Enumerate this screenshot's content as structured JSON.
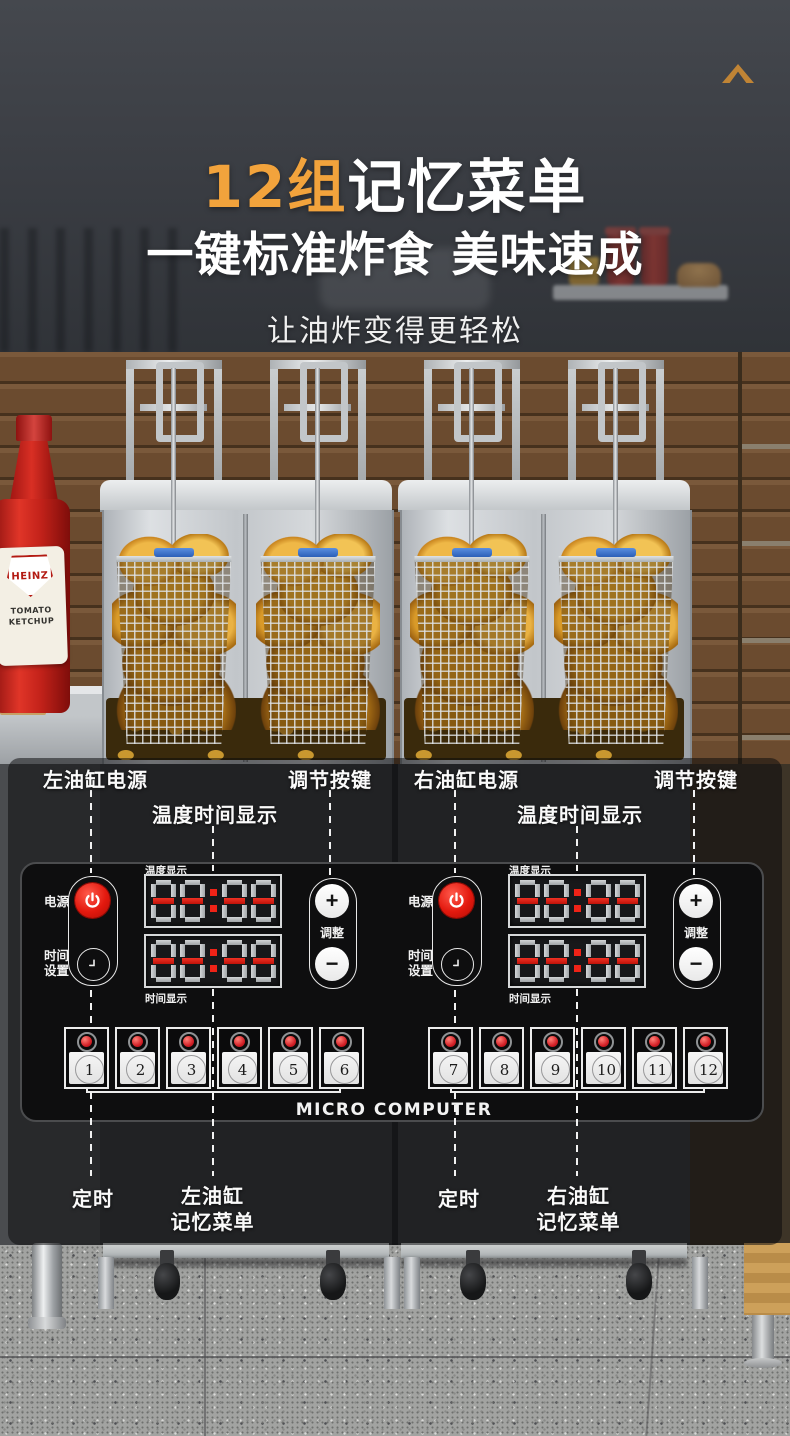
{
  "header": {
    "title_highlight": "12组",
    "title_rest": "记忆菜单",
    "subtitle": "一键标准炸食 美味速成",
    "tagline": "让油炸变得更轻松",
    "accent_color": "#f2a33c"
  },
  "photo": {
    "ketchup_brand": "HEINZ",
    "ketchup_label": "TOMATO KETCHUP"
  },
  "callouts": {
    "left_power": "左油缸电源",
    "left_display": "温度时间显示",
    "left_adjust": "调节按键",
    "right_power": "右油缸电源",
    "right_display": "温度时间显示",
    "right_adjust": "调节按键",
    "left_timer": "定时",
    "left_memory_line1": "左油缸",
    "left_memory_line2": "记忆菜单",
    "right_timer": "定时",
    "right_memory_line1": "右油缸",
    "right_memory_line2": "记忆菜单"
  },
  "panel": {
    "brand": "MICRO COMPUTER",
    "left": {
      "power_label": "电源",
      "time_set_line1": "时间",
      "time_set_line2": "设置",
      "temp_display_label": "温度显示",
      "time_display_label": "时间显示",
      "temp_display_value": "--:--",
      "time_display_value": "--:--",
      "adjust_label": "调整",
      "plus": "+",
      "minus": "−",
      "memory_buttons": [
        "1",
        "2",
        "3",
        "4",
        "5",
        "6"
      ]
    },
    "right": {
      "power_label": "电源",
      "time_set_line1": "时间",
      "time_set_line2": "设置",
      "temp_display_label": "温度显示",
      "time_display_label": "时间显示",
      "temp_display_value": "--:--",
      "time_display_value": "--:--",
      "adjust_label": "调整",
      "plus": "+",
      "minus": "−",
      "memory_buttons": [
        "7",
        "8",
        "9",
        "10",
        "11",
        "12"
      ]
    }
  }
}
